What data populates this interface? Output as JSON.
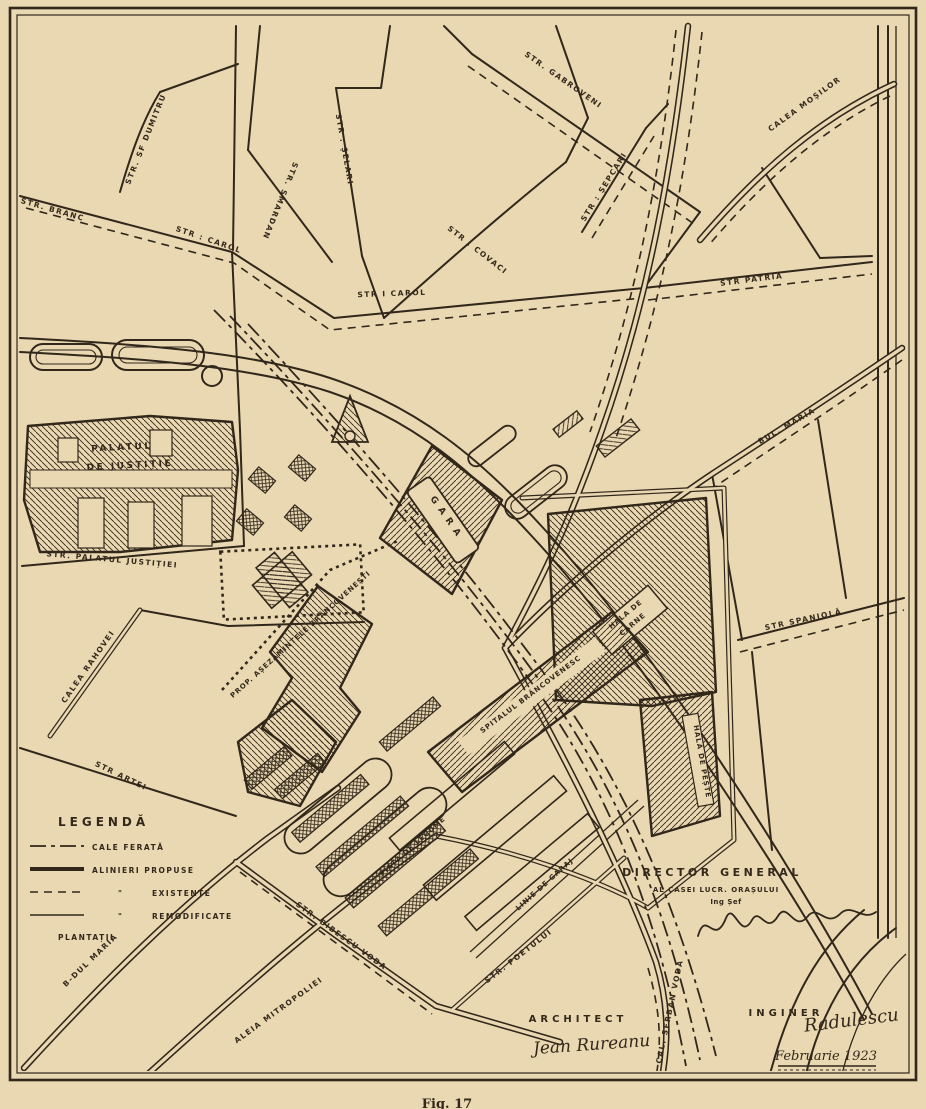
{
  "palette": {
    "paper": "#e9d8b2",
    "ink": "#31271a"
  },
  "legend": {
    "title": "LEGENDĂ",
    "items": [
      {
        "label": "CALE FERATĂ",
        "style": "dashdot",
        "ditto": ""
      },
      {
        "label": "ALINIERI PROPUSE",
        "style": "thick",
        "ditto": ""
      },
      {
        "label": "EXISTENTE",
        "style": "dashed",
        "ditto": "\""
      },
      {
        "label": "REMODIFICATE",
        "style": "thin",
        "ditto": "\""
      },
      {
        "label": "PLANTAȚII",
        "style": "none",
        "ditto": ""
      }
    ]
  },
  "streets": {
    "branc": "STR. BRANC",
    "sf_dumitru": "STR. SF DUMITRU",
    "smardan": "STR. SMARDAN",
    "selari": "STR : ȘELARI",
    "carol_upper": "STR : CAROL",
    "carol": "STR I CAROL",
    "covaci": "STR : COVACI",
    "gabroveni": "STR. GABROVENI",
    "sepcari": "STR : ȘEPCARI",
    "mosilor": "CALEA MOȘILOR",
    "patria": "STR PATRIA",
    "bul_maria": "BUL. MARIA",
    "spaniola": "STR SPANIOLĂ",
    "palat_justitiei": "STR. PALATUL JUSTIȚIEI",
    "rahovei": "CALEA RAHOVEI",
    "artei": "STR ARTEI",
    "bibescu_voda": "STR. BIBESCU VODA",
    "poetului": "STR. POETULUI",
    "bdul_maria": "B-DUL MARIA",
    "aleia_mitropoliei": "ALEIA MITROPOLIEI",
    "serban_voda": "CAL. ȘERBAN VODA"
  },
  "buildings": {
    "palace_l1": "PALATUL",
    "palace_l2": "DE JUSTIȚIE",
    "station": "GARA",
    "meat_hall_l1": "HALA DE",
    "meat_hall_l2": "CARNE",
    "fish_hall": "HALA DE PEȘTE",
    "hospital": "SPITALUL BRÂNCOVENESC",
    "estates": "PROP. AȘEZĂMINTELE BRÂNCOVENEȘTI"
  },
  "annotations": {
    "market": "PIAȚA DE LEGUME",
    "siding": "LINIE DE GARAJ"
  },
  "credits": {
    "director_title": "DIRECTOR GENERAL",
    "director_sub": "AL CASEI LUCR. ORAȘULUI",
    "director_role": "Ing Șef",
    "architect_title": "ARCHITECT",
    "architect_signature": "Jean Rureanu",
    "engineer_title": "INGINER",
    "engineer_signature": "Radulescu",
    "date": "Februarie 1923"
  },
  "caption": "Fig. 17"
}
